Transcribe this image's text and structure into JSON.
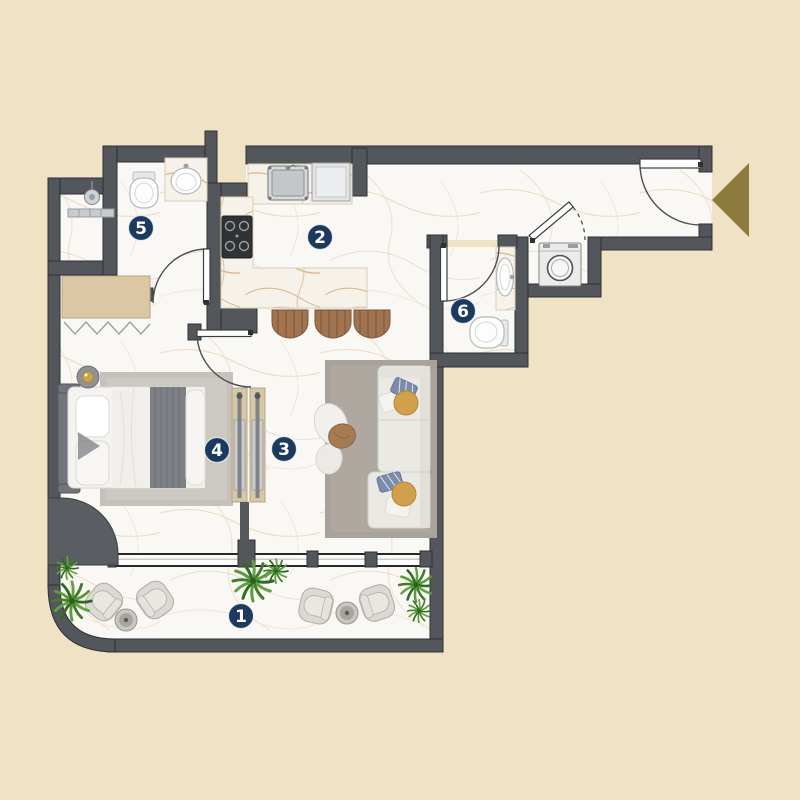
{
  "floor_plan": {
    "markers": [
      {
        "room": "balcony",
        "label": "1"
      },
      {
        "room": "kitchen",
        "label": "2"
      },
      {
        "room": "living-area",
        "label": "3"
      },
      {
        "room": "bedroom",
        "label": "4"
      },
      {
        "room": "bathroom",
        "label": "5"
      },
      {
        "room": "ensuite-bathroom",
        "label": "6"
      }
    ],
    "colors": {
      "background": "#f0e2c5",
      "wall": "#53565b",
      "floor": "#faf8f5",
      "marker": "#1c3a5e",
      "marker_text": "#ffffff",
      "entrance_arrow": "#8d7b3d",
      "wood": "#d6c8a5",
      "plant_green": "#4a8f35",
      "rug_gray": "#a8a29b",
      "cushion_gold": "#d0a14a"
    },
    "entrance": {
      "symbol": "left-pointing-triangle"
    },
    "furniture_icons": [
      "bed",
      "wardrobe",
      "sliding-door",
      "sofa",
      "coffee-table",
      "kitchen-sink",
      "stove",
      "bar-stool",
      "toilet",
      "washbasin",
      "shower",
      "washing-machine",
      "armchair",
      "side-table",
      "plant"
    ]
  }
}
